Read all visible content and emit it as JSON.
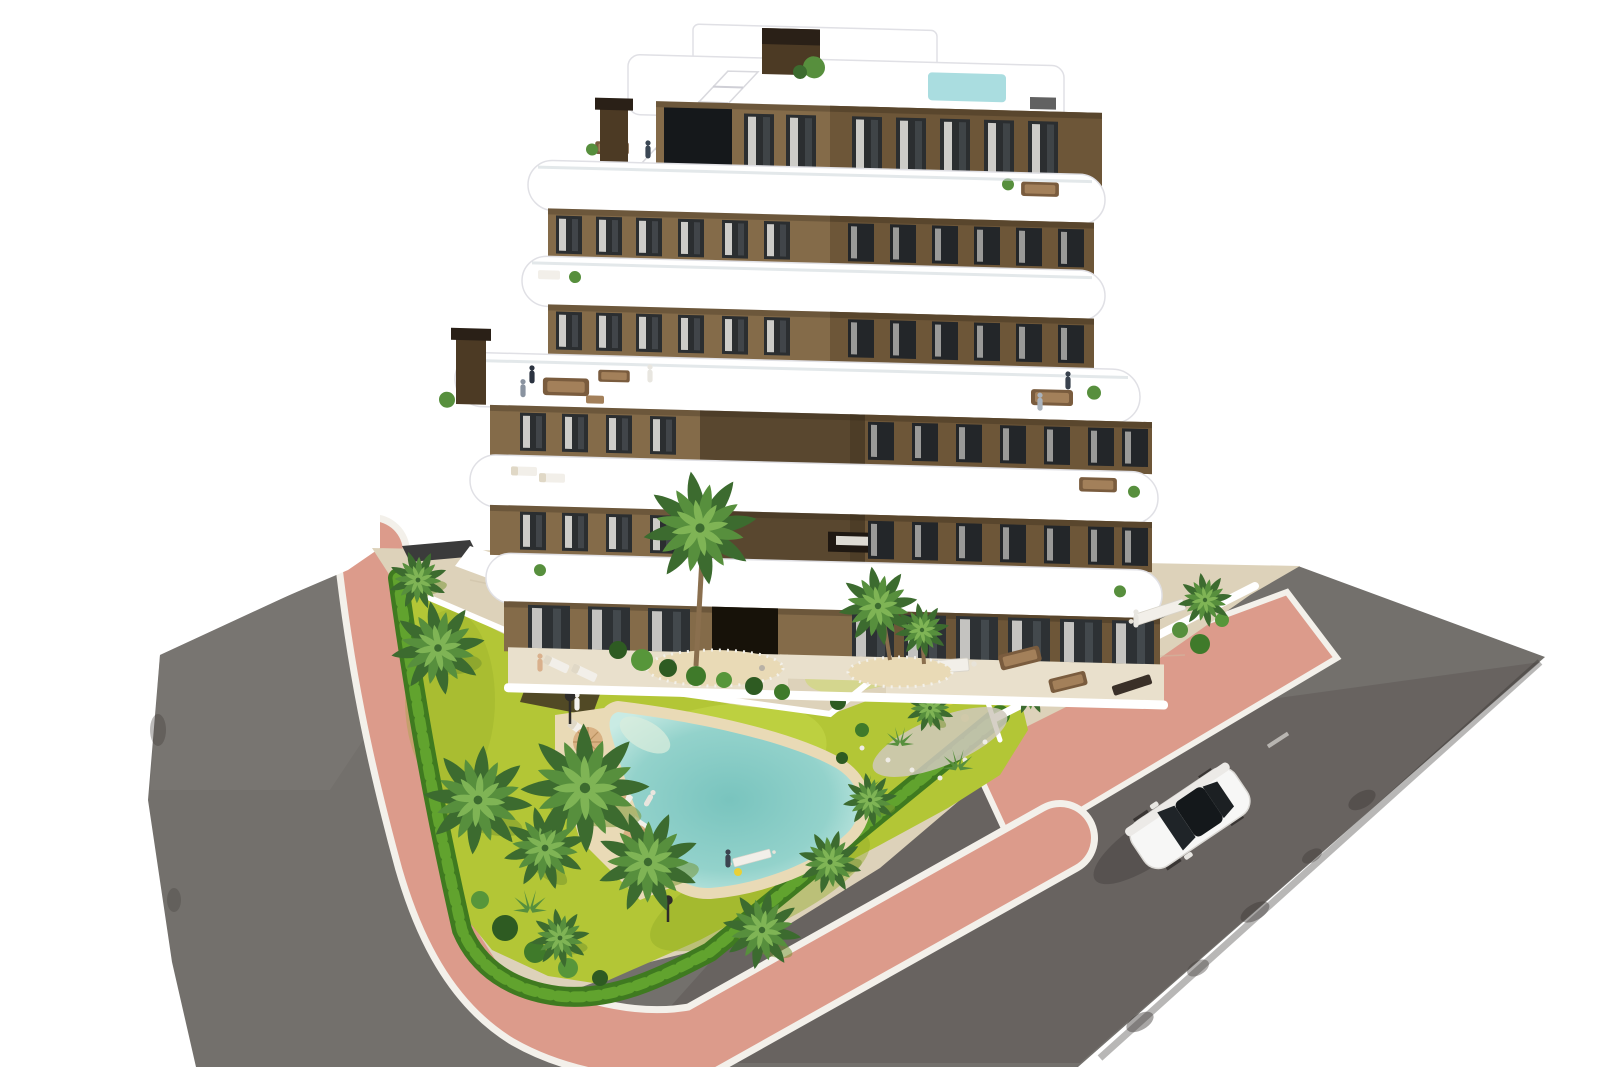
{
  "scene": {
    "type": "3d-architectural-rendering",
    "view": "aerial-three-quarter",
    "background": "plain white",
    "subject": "modern seven-storey apartment building with curved white balcony bands and brown facade, landscaped garden with free-form pool, salmon sidewalk, asphalt road and one white car"
  },
  "counts": {
    "building_floors_visible": 7,
    "rooftop_pools": 1,
    "garden_pools": 1,
    "palm_trees": 16,
    "sun_loungers": 5,
    "parasols": 3,
    "chimneys": 2,
    "cars": 1
  },
  "colors": {
    "bg": "#ffffff",
    "road": "#73706c",
    "road-light": "#7e7a76",
    "road-dark": "#5e5a57",
    "path-pink": "#dc9b8b",
    "curb": "#f3f0ea",
    "beige": "#ddd2ba",
    "beige-light": "#e9e0cc",
    "grass": "#b3c636",
    "grass-light": "#c9dc4e",
    "grass-dark": "#93aa28",
    "hedge": "#3f7a20",
    "hedge-light": "#61a32e",
    "palm-dark": "#3c6b2f",
    "palm-mid": "#578f3d",
    "palm-light": "#7fb455",
    "trunk": "#8a6f4e",
    "sand": "#e9dab6",
    "roofpool": "#aadde0",
    "facade": "#846b49",
    "facade-dark": "#6d5638",
    "window": "#2b2e30",
    "window-dark": "#232629",
    "glass": "#15181b",
    "curtain": "#eae8e3",
    "chimney": "#4c3a24",
    "chimney-cap": "#2a2017",
    "band-stroke": "#e0e0e5",
    "furniture-brown": "#7a5c3e",
    "furniture-white": "#f2efe9",
    "umbrella": "#d9b183",
    "stone": "#cfc8bc",
    "car-white": "#f7f7f6",
    "car-glass": "#1f2428",
    "shadow": "#454240"
  }
}
